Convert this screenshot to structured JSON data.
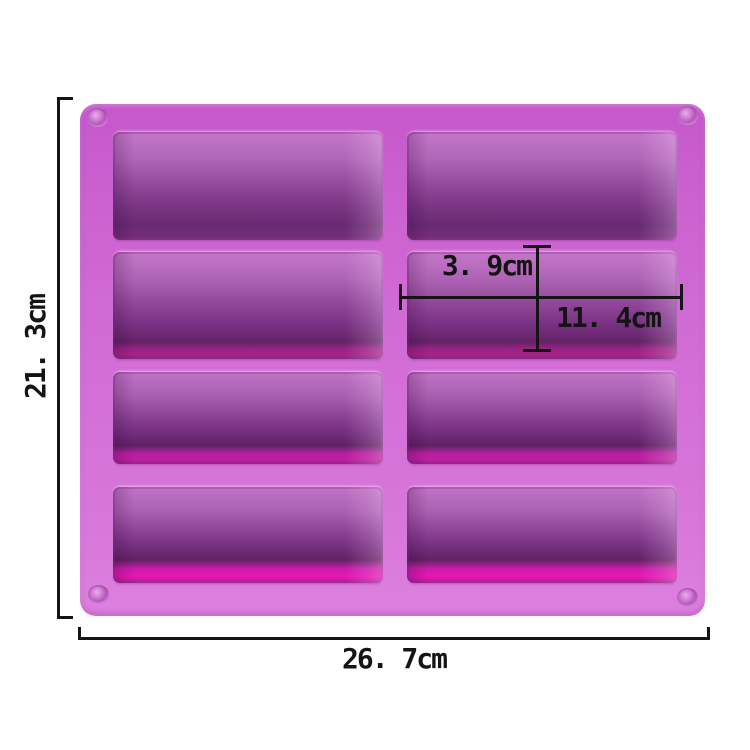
{
  "background_color": "#ffffff",
  "product": {
    "name": "8-cavity rectangle silicone mold",
    "grid": {
      "rows": 4,
      "columns": 2,
      "cavities": 8
    },
    "colors": {
      "body": "#ce66d2",
      "body_highlight": "#dc80de",
      "cavity_light": "#c377c8",
      "cavity_dark": "#6b2b74",
      "cavity_glow": "#ea14b4"
    }
  },
  "dimensions": {
    "line_color": "#151515",
    "overall_height": "21. 3cm",
    "overall_width": "26. 7cm",
    "cavity_depth": "3. 9cm",
    "cavity_width": "11. 4cm"
  }
}
